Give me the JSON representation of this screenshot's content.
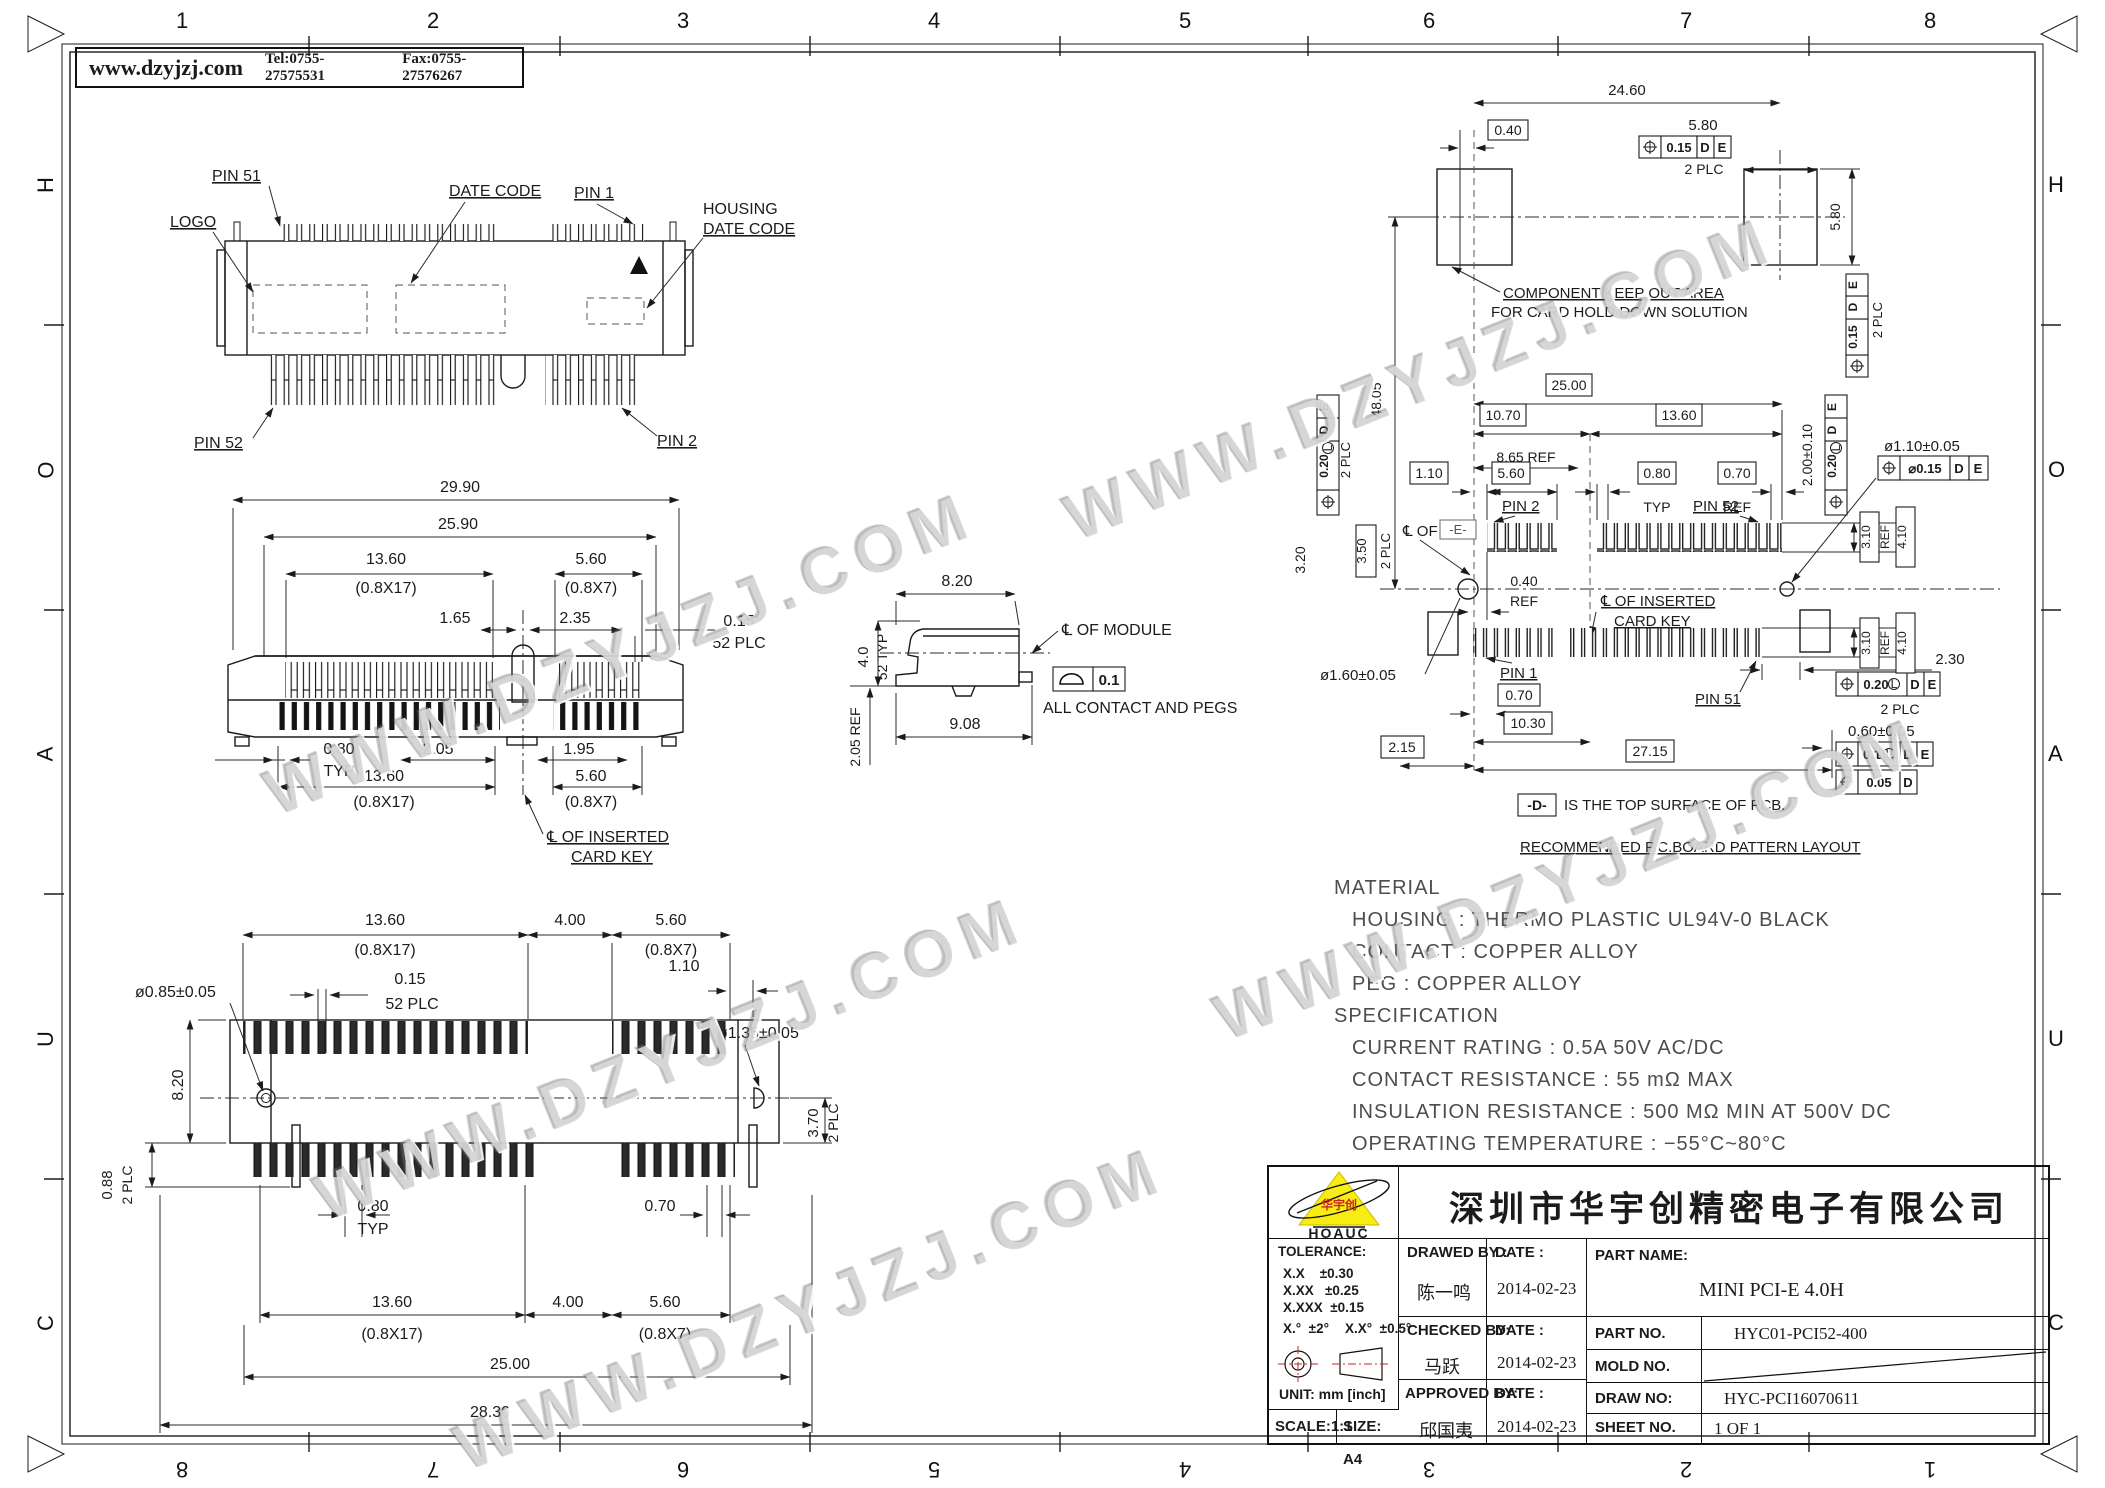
{
  "header": {
    "website": "www.dzyjzj.com",
    "tel": "Tel:0755-27575531",
    "fax": "Fax:0755-27576267"
  },
  "watermark": {
    "text": "WWW.DZYJZJ.COM"
  },
  "border": {
    "cols_top": [
      "1",
      "2",
      "3",
      "4",
      "5",
      "6",
      "7",
      "8"
    ],
    "cols_bottom": [
      "8",
      "7",
      "6",
      "5",
      "4",
      "3",
      "2",
      "1"
    ],
    "rows_left": [
      "H",
      "O",
      "A",
      "U",
      "C"
    ],
    "rows_right": [
      "H",
      "O",
      "A",
      "U",
      "C"
    ]
  },
  "top_view": {
    "pin51": "PIN 51",
    "datecode": "DATE CODE",
    "pin1": "PIN 1",
    "housing1": "HOUSING",
    "housing2": "DATE CODE",
    "logo": "LOGO",
    "pin52": "PIN 52",
    "pin2": "PIN 2"
  },
  "front_view": {
    "w1": "29.90",
    "w2": "25.90",
    "g1": "13.60",
    "g1p": "(0.8X17)",
    "g2": "5.60",
    "g2p": "(0.8X7)",
    "d165": "1.65",
    "d235": "2.35",
    "d015": "0.15",
    "plc52": "52 PLC",
    "d080": "0.80",
    "typ": "TYP",
    "d205": "2.05",
    "d195": "1.95",
    "b1": "13.60",
    "b1p": "(0.8X17)",
    "b2": "5.60",
    "b2p": "(0.8X7)",
    "cl1": "℄ OF INSERTED",
    "cl2": "CARD KEY"
  },
  "side_view": {
    "d820": "8.20",
    "d40": "4.0",
    "typ52": "52 TYP",
    "ref205": "2.05 REF",
    "d908": "9.08",
    "cl": "℄ OF MODULE",
    "tol": "0.1",
    "note": "ALL CONTACT AND PEGS"
  },
  "bottom_view": {
    "t1": "13.60",
    "t1p": "(0.8X17)",
    "t2": "4.00",
    "t3": "5.60",
    "t3p": "(0.8X7)",
    "d015": "0.15",
    "plc52": "52 PLC",
    "holel": "ø0.85±0.05",
    "d110": "1.10",
    "holer": "ø1.35±0.05",
    "h820": "8.20",
    "d370": "3.70",
    "plc2": "2 PLC",
    "d088": "0.88",
    "d080": "0.80",
    "typ": "TYP",
    "d070": "0.70",
    "b1": "13.60",
    "b1p": "(0.8X17)",
    "b2": "4.00",
    "b3": "5.60",
    "b3p": "(0.8X7)",
    "d2500": "25.00",
    "d2830": "28.30"
  },
  "pcb": {
    "d2460": "24.60",
    "d040": "0.40",
    "d580": "5.80",
    "t015": "0.15",
    "D": "D",
    "E": "E",
    "plc2": "2 PLC",
    "keep1": "COMPONENT KEEP OUT AREA",
    "keep2": "FOR CARD HOLD DOWN SOLUTION",
    "d4805": "48.05",
    "d2500": "25.00",
    "d1070": "10.70",
    "d1360": "13.60",
    "d865": "8.65 REF",
    "d110": "1.10",
    "d560": "5.60",
    "d080": "0.80",
    "typ": "TYP",
    "d070": "0.70",
    "ref": "REF",
    "pin2": "PIN 2",
    "pin52": "PIN 52",
    "d200": "2.00±0.10",
    "t020": "0.20",
    "L": "L",
    "holer": "ø1.10±0.05",
    "t015d": "⌀0.15",
    "cle": "℄ OF",
    "ebox": "-E-",
    "d040r": "0.40",
    "clk1": "℄ OF INSERTED",
    "clk2": "CARD KEY",
    "d320": "3.20",
    "d350": "3.50",
    "d310": "3.10",
    "d410": "4.10",
    "holel": "ø1.60±0.05",
    "pin1": "PIN 1",
    "d070b": "0.70",
    "d1030": "10.30",
    "d215": "2.15",
    "d2715": "27.15",
    "pin51": "PIN 51",
    "d230": "2.30",
    "d060": "0.60±0.05",
    "t01": "0.1",
    "t005": "0.05",
    "noted": "-D-",
    "notedtxt": "IS THE TOP SURFACE OF PCB.",
    "noterec": "RECOMMENDED P.C.BOARD PATTERN LAYOUT"
  },
  "material": {
    "title": "MATERIAL",
    "l1": "HOUSING : THERMO PLASTIC UL94V-0 BLACK",
    "l2": "CONTACT : COPPER ALLOY",
    "l3": "PEG : COPPER ALLOY",
    "spec": "SPECIFICATION",
    "l4": "CURRENT RATING : 0.5A 50V AC/DC",
    "l5": "CONTACT RESISTANCE : 55 mΩ MAX",
    "l6": "INSULATION RESISTANCE : 500 MΩ MIN AT 500V DC",
    "l7": "OPERATING TEMPERATURE : −55°C~80°C"
  },
  "title_block": {
    "company": "深圳市华宇创精密电子有限公司",
    "logo_text": "HOAUC",
    "logo_cn": "华宇创",
    "tolerance_title": "TOLERANCE:",
    "tol1": "X.X    ±0.30",
    "tol2": "X.XX   ±0.25",
    "tol3": "X.XXX  ±0.15",
    "tol4": "X.°  ±2°",
    "tol5": "X.X°  ±0.5°",
    "unit": "UNIT:  mm  [inch]",
    "scale": "SCALE:1:1",
    "size": "SIZE:  A4",
    "drawed_label": "DRAWED BY :",
    "drawed_name": "陈一鸣",
    "date_label": "DATE :",
    "drawed_date": "2014-02-23",
    "checked_label": "CHECKED BY:",
    "checked_name": "马跃",
    "checked_date": "2014-02-23",
    "approved_label": "APPROVED BY:",
    "approved_name": "邱国夷",
    "approved_date": "2014-02-23",
    "part_name_label": "PART NAME:",
    "part_name": "MINI PCI-E 4.0H",
    "part_no_label": "PART NO.",
    "part_no": "HYC01-PCI52-400",
    "mold_no_label": "MOLD NO.",
    "draw_no_label": "DRAW NO:",
    "draw_no": "HYC-PCI16070611",
    "sheet_no_label": "SHEET NO.",
    "sheet_no": "1 OF 1"
  }
}
